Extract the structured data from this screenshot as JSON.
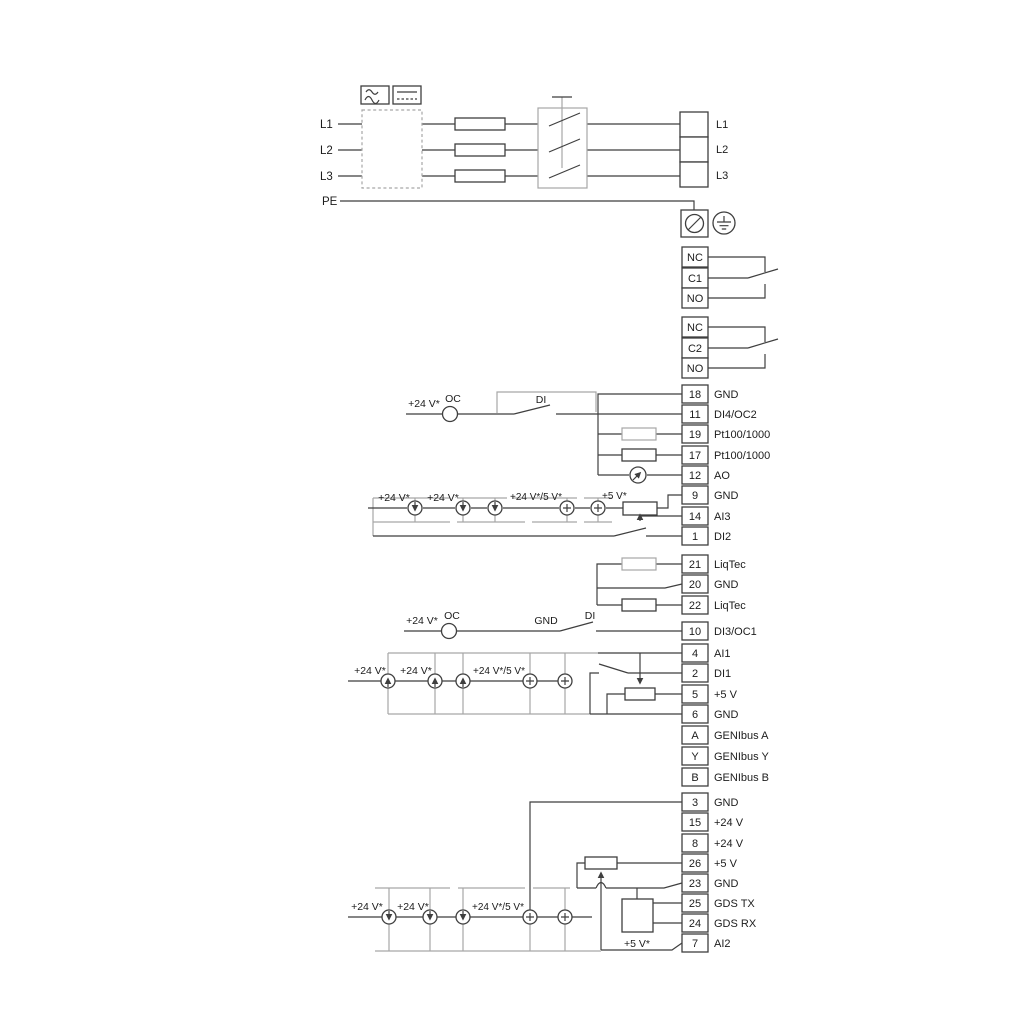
{
  "power": {
    "left": [
      "L1",
      "L2",
      "L3",
      "PE"
    ],
    "right": [
      "L1",
      "L2",
      "L3"
    ]
  },
  "relay1": [
    "NC",
    "C1",
    "NO"
  ],
  "relay2": [
    "NC",
    "C2",
    "NO"
  ],
  "io1": [
    {
      "n": "18",
      "t": "GND"
    },
    {
      "n": "11",
      "t": "DI4/OC2"
    },
    {
      "n": "19",
      "t": "Pt100/1000"
    },
    {
      "n": "17",
      "t": "Pt100/1000"
    },
    {
      "n": "12",
      "t": "AO"
    },
    {
      "n": "9",
      "t": "GND"
    },
    {
      "n": "14",
      "t": "AI3"
    },
    {
      "n": "1",
      "t": "DI2"
    }
  ],
  "liq": [
    {
      "n": "21",
      "t": "LiqTec"
    },
    {
      "n": "20",
      "t": "GND"
    },
    {
      "n": "22",
      "t": "LiqTec"
    }
  ],
  "di3": {
    "n": "10",
    "t": "DI3/OC1"
  },
  "io2": [
    {
      "n": "4",
      "t": "AI1"
    },
    {
      "n": "2",
      "t": "DI1"
    },
    {
      "n": "5",
      "t": "+5 V"
    },
    {
      "n": "6",
      "t": "GND"
    }
  ],
  "genibus": [
    {
      "n": "A",
      "t": "GENIbus A"
    },
    {
      "n": "Y",
      "t": "GENIbus Y"
    },
    {
      "n": "B",
      "t": "GENIbus B"
    }
  ],
  "io3": [
    {
      "n": "3",
      "t": "GND"
    },
    {
      "n": "15",
      "t": "+24 V"
    },
    {
      "n": "8",
      "t": "+24 V"
    },
    {
      "n": "26",
      "t": "+5 V"
    },
    {
      "n": "23",
      "t": "GND"
    },
    {
      "n": "25",
      "t": "GDS TX"
    },
    {
      "n": "24",
      "t": "GDS RX"
    },
    {
      "n": "7",
      "t": "AI2"
    }
  ],
  "ann": {
    "v24": "+24 V*",
    "v24v5": "+24 V*/5 V*",
    "v5": "+5 V*",
    "oc": "OC",
    "di": "DI",
    "gnd": "GND"
  },
  "colors": {
    "wire": "#3f3f3f",
    "wire_gray": "#a6a6a6",
    "text": "#1c1c1c",
    "background": "#ffffff"
  }
}
